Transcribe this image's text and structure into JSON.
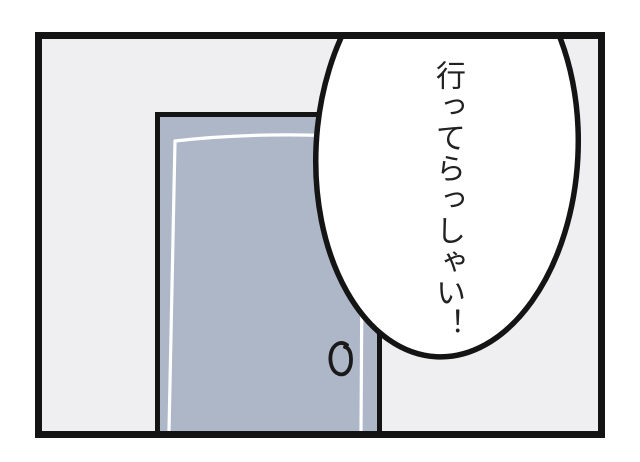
{
  "panel": {
    "wall_color": "#efeef0",
    "border_color": "#141414"
  },
  "door": {
    "fill_color": "#aeb7c8",
    "outline_color": "#141414",
    "inner_line_color": "#ffffff",
    "knob_color": "#1a1a1a"
  },
  "bubble": {
    "text": "行ってらっしゃい！",
    "fill": "#ffffff",
    "stroke": "#141414",
    "text_color": "#222222"
  }
}
